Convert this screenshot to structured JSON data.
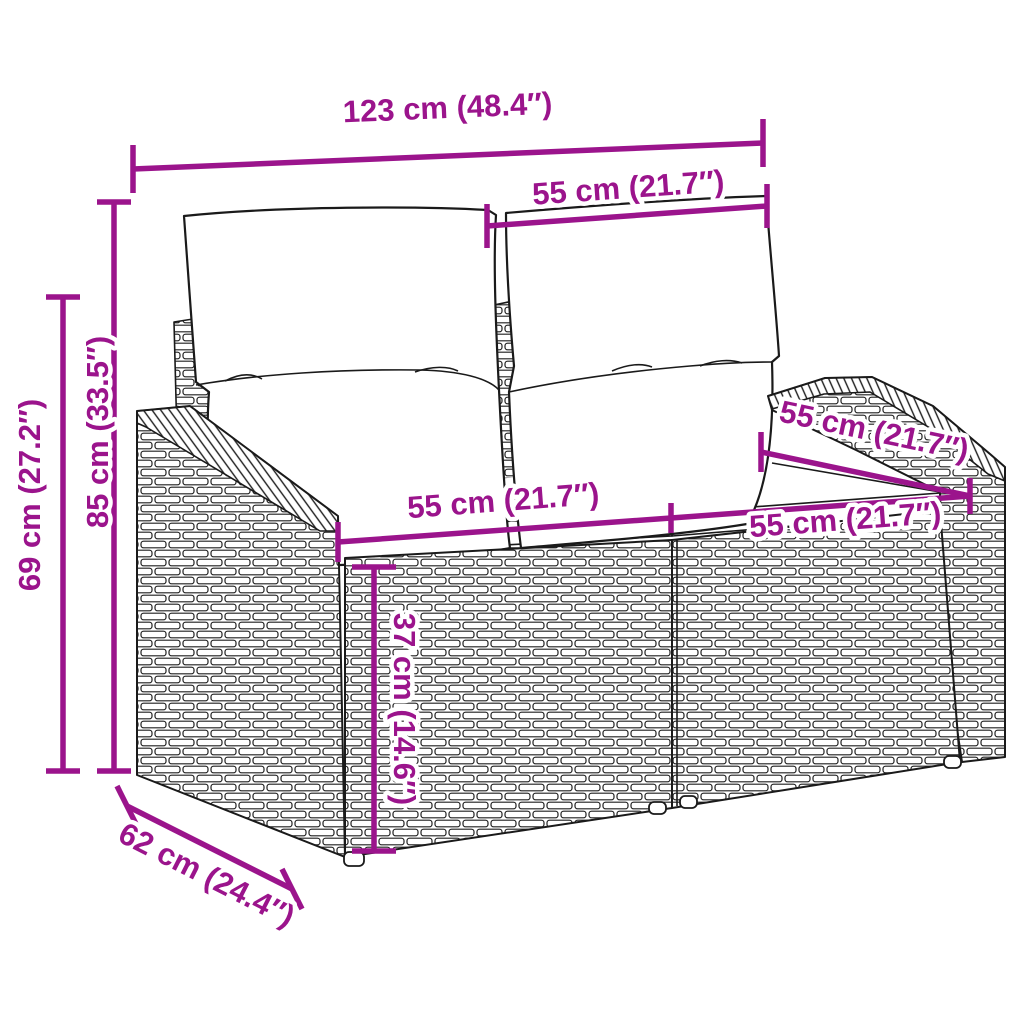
{
  "diagram": {
    "subject": "poly-rattan garden loveseat with back and seat cushions",
    "colors": {
      "dimension_accent": "#9B148C",
      "outline": "#1A1A1A",
      "background": "#FFFFFF",
      "cushion": "#FFFFFF"
    },
    "dimensions": {
      "overall_width": "123 cm (48.4″)",
      "back_cushion_width": "55 cm (21.7″)",
      "overall_height": "85 cm (33.5″)",
      "armrest_height": "69 cm (27.2″)",
      "seat_width_left": "55 cm (21.7″)",
      "seat_width_right": "55 cm (21.7″)",
      "seat_depth": "55 cm (21.7″)",
      "seat_height": "37 cm (14.6″)",
      "overall_depth": "62 cm (24.4″)"
    }
  }
}
